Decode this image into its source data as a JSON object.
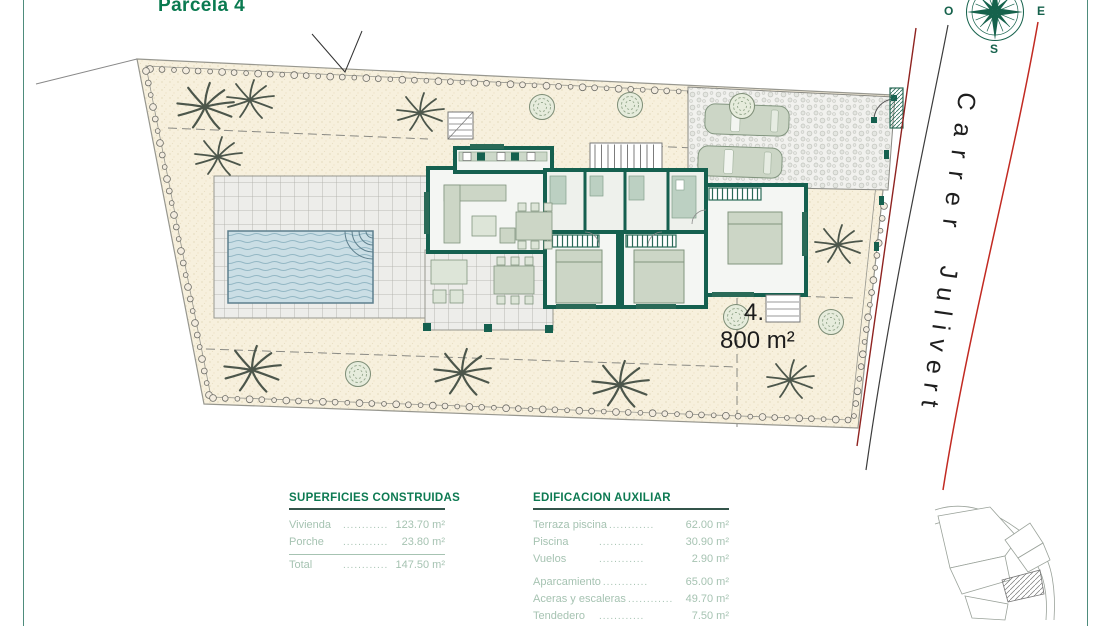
{
  "page": {
    "title": "Parcela 4"
  },
  "compass": {
    "west": "O",
    "east": "E",
    "south": "S"
  },
  "street": {
    "word1": "Carrer",
    "word2": "Julivert"
  },
  "parcel": {
    "number": "4.",
    "area": "800 m²"
  },
  "surfaces_table": {
    "title": "SUPERFICIES CONSTRUIDAS",
    "rows": [
      {
        "label": "Vivienda",
        "leader": "............",
        "value": "123.70 m²"
      },
      {
        "label": "Porche",
        "leader": "............",
        "value": "23.80 m²"
      }
    ],
    "total_row": {
      "label": "Total",
      "leader": "............",
      "value": "147.50 m²"
    }
  },
  "auxiliary_table": {
    "title": "EDIFICACION AUXILIAR",
    "group1": [
      {
        "label": "Terraza piscina",
        "leader": "............",
        "value": "62.00 m²"
      },
      {
        "label": "Piscina",
        "leader": "............",
        "value": "30.90 m²"
      },
      {
        "label": "Vuelos",
        "leader": "............",
        "value": "2.90 m²"
      }
    ],
    "group2": [
      {
        "label": "Aparcamiento",
        "leader": "............",
        "value": "65.00 m²"
      },
      {
        "label": "Aceras y escaleras",
        "leader": "............",
        "value": "49.70 m²"
      },
      {
        "label": "Tendedero",
        "leader": "............",
        "value": "7.50 m²"
      },
      {
        "label": "Acabado gravilla",
        "leader": "............",
        "value": "402.00 m²"
      }
    ]
  },
  "colors": {
    "accent_green": "#0a7a50",
    "wall_green": "#15604f",
    "ground_beige": "#f7f0dd",
    "pool_blue": "#cadee5",
    "road_red": "#c22a22",
    "boundary_red": "#8f2320",
    "table_text_sage": "#a6c3b2"
  }
}
